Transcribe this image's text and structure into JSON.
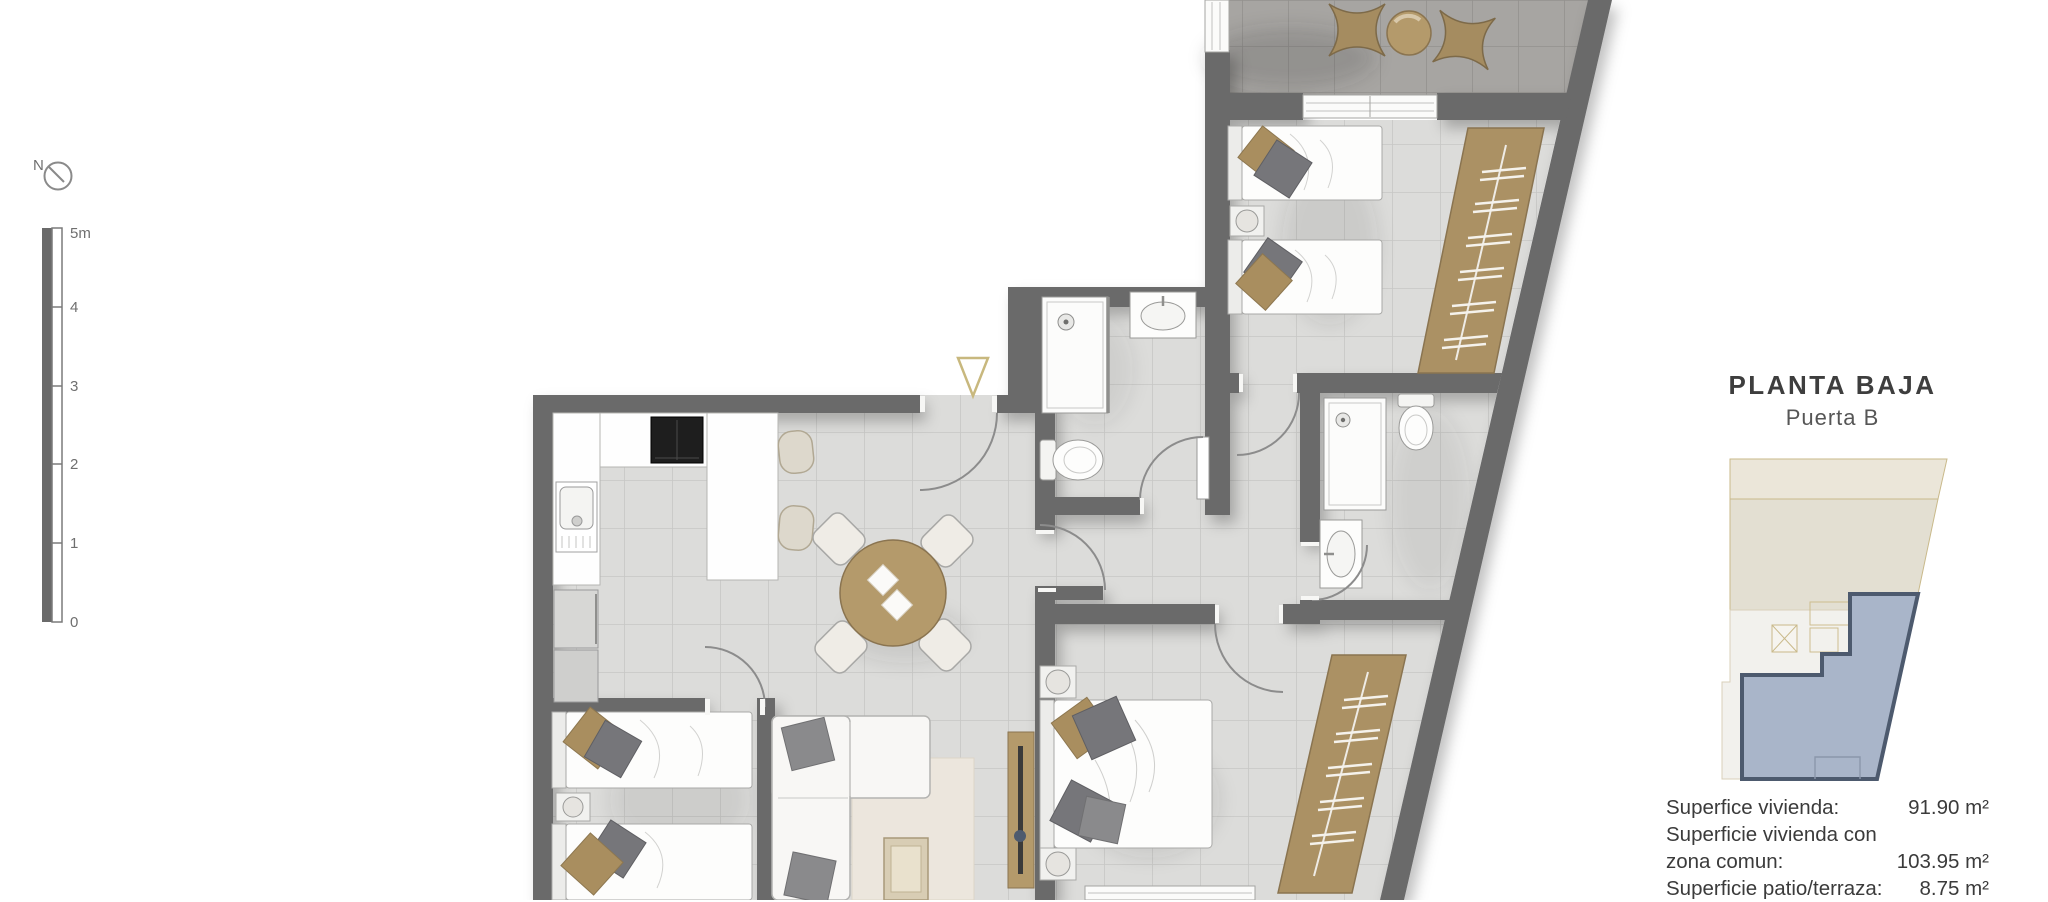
{
  "compass": {
    "label": "N"
  },
  "scale_bar": {
    "labels": [
      "5m",
      "4",
      "3",
      "2",
      "1",
      "0"
    ]
  },
  "panel": {
    "title": "PLANTA BAJA",
    "subtitle": "Puerta B",
    "areas": [
      {
        "line1": "Superfice vivienda:",
        "line2": "",
        "value": "91.90 m²"
      },
      {
        "line1": "Superficie vivienda con",
        "line2": "zona comun:",
        "value": "103.95 m²"
      },
      {
        "line1": "Superficie patio/terraza:",
        "line2": "",
        "value": "8.75 m²"
      }
    ]
  },
  "colors": {
    "wall": "#6a6a6a",
    "floor_tile": "#dcdcda",
    "terrace_tile": "#a7a5a2",
    "wood": "#b49a6b",
    "wardrobe": "#ab9164",
    "pillow_tan": "#a98e5f",
    "pillow_gray": "#76767a",
    "entrance_marker": "#c8b87e",
    "minimap_unit_fill": "#a9b5c9",
    "minimap_unit_border": "#4d5a6e",
    "minimap_building_beige": "#e9e4d7",
    "text_dark": "#3b3b3b"
  }
}
